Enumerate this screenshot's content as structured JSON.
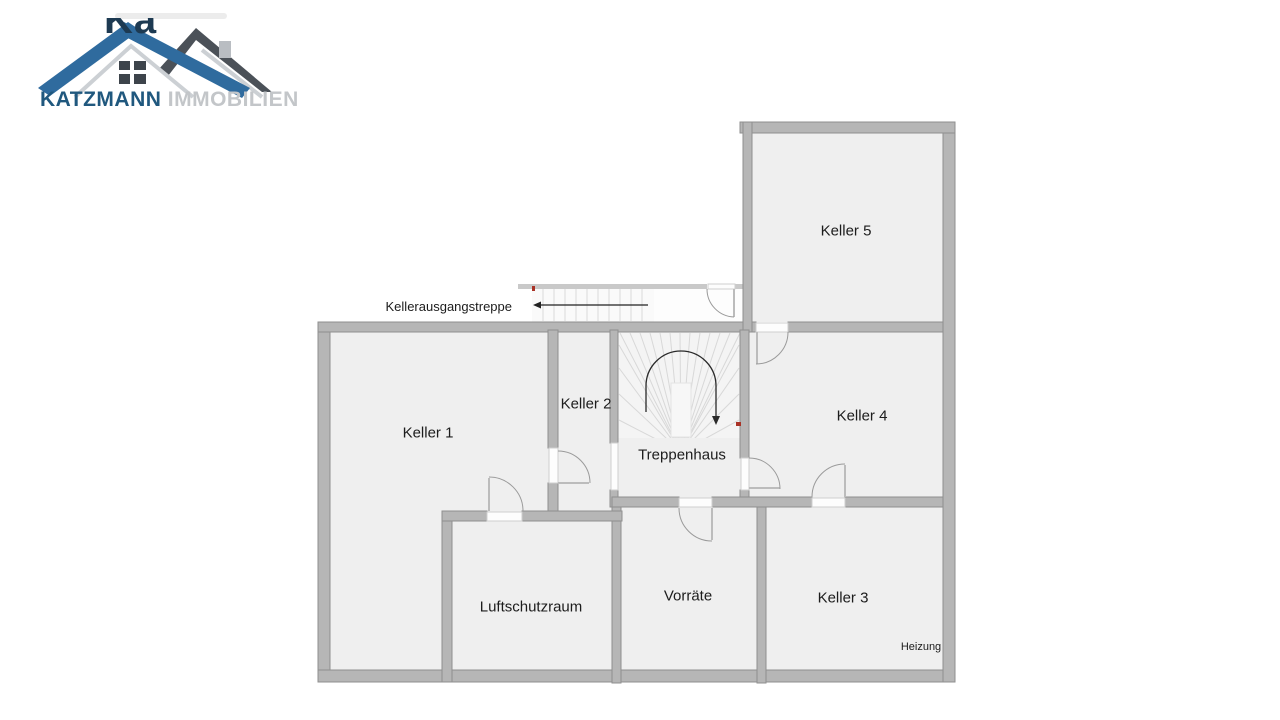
{
  "watermark": {
    "fragment": "Ka"
  },
  "logo": {
    "brand_primary": "KATZMANN",
    "brand_secondary": "IMMOBILIEN"
  },
  "plan": {
    "rooms": [
      {
        "id": "keller-1",
        "name": "Keller 1"
      },
      {
        "id": "keller-2",
        "name": "Keller 2"
      },
      {
        "id": "keller-3",
        "name": "Keller 3"
      },
      {
        "id": "keller-4",
        "name": "Keller 4"
      },
      {
        "id": "keller-5",
        "name": "Keller 5"
      },
      {
        "id": "treppenhaus",
        "name": "Treppenhaus"
      },
      {
        "id": "luftschutzraum",
        "name": "Luftschutzraum"
      },
      {
        "id": "vorraete",
        "name": "Vorräte"
      }
    ],
    "annotations": [
      {
        "id": "kellerausgangstreppe",
        "text": "Kellerausgangstreppe"
      },
      {
        "id": "heizung",
        "text": "Heizung"
      }
    ]
  },
  "colors": {
    "bg": "#ffffff",
    "wall": "#b6b6b6",
    "wallEdge": "#8f8f8f",
    "floor": "#efefef",
    "thinWall": "#c9c9c9",
    "doorArc": "#9a9a9a",
    "doorGap": "#fdfdfd",
    "stairLine": "#d9d9d9",
    "fanLine": "#d8d8d8",
    "label": "#1c1c1c",
    "accentRed": "#a93226",
    "logoBlue": "#2f6b9e",
    "logoDark": "#4b5158",
    "logoSilver": "#ccd0d4",
    "brandBlue": "#20587e",
    "brandGray": "#c3c6c9",
    "windowDark": "#3d444b"
  }
}
